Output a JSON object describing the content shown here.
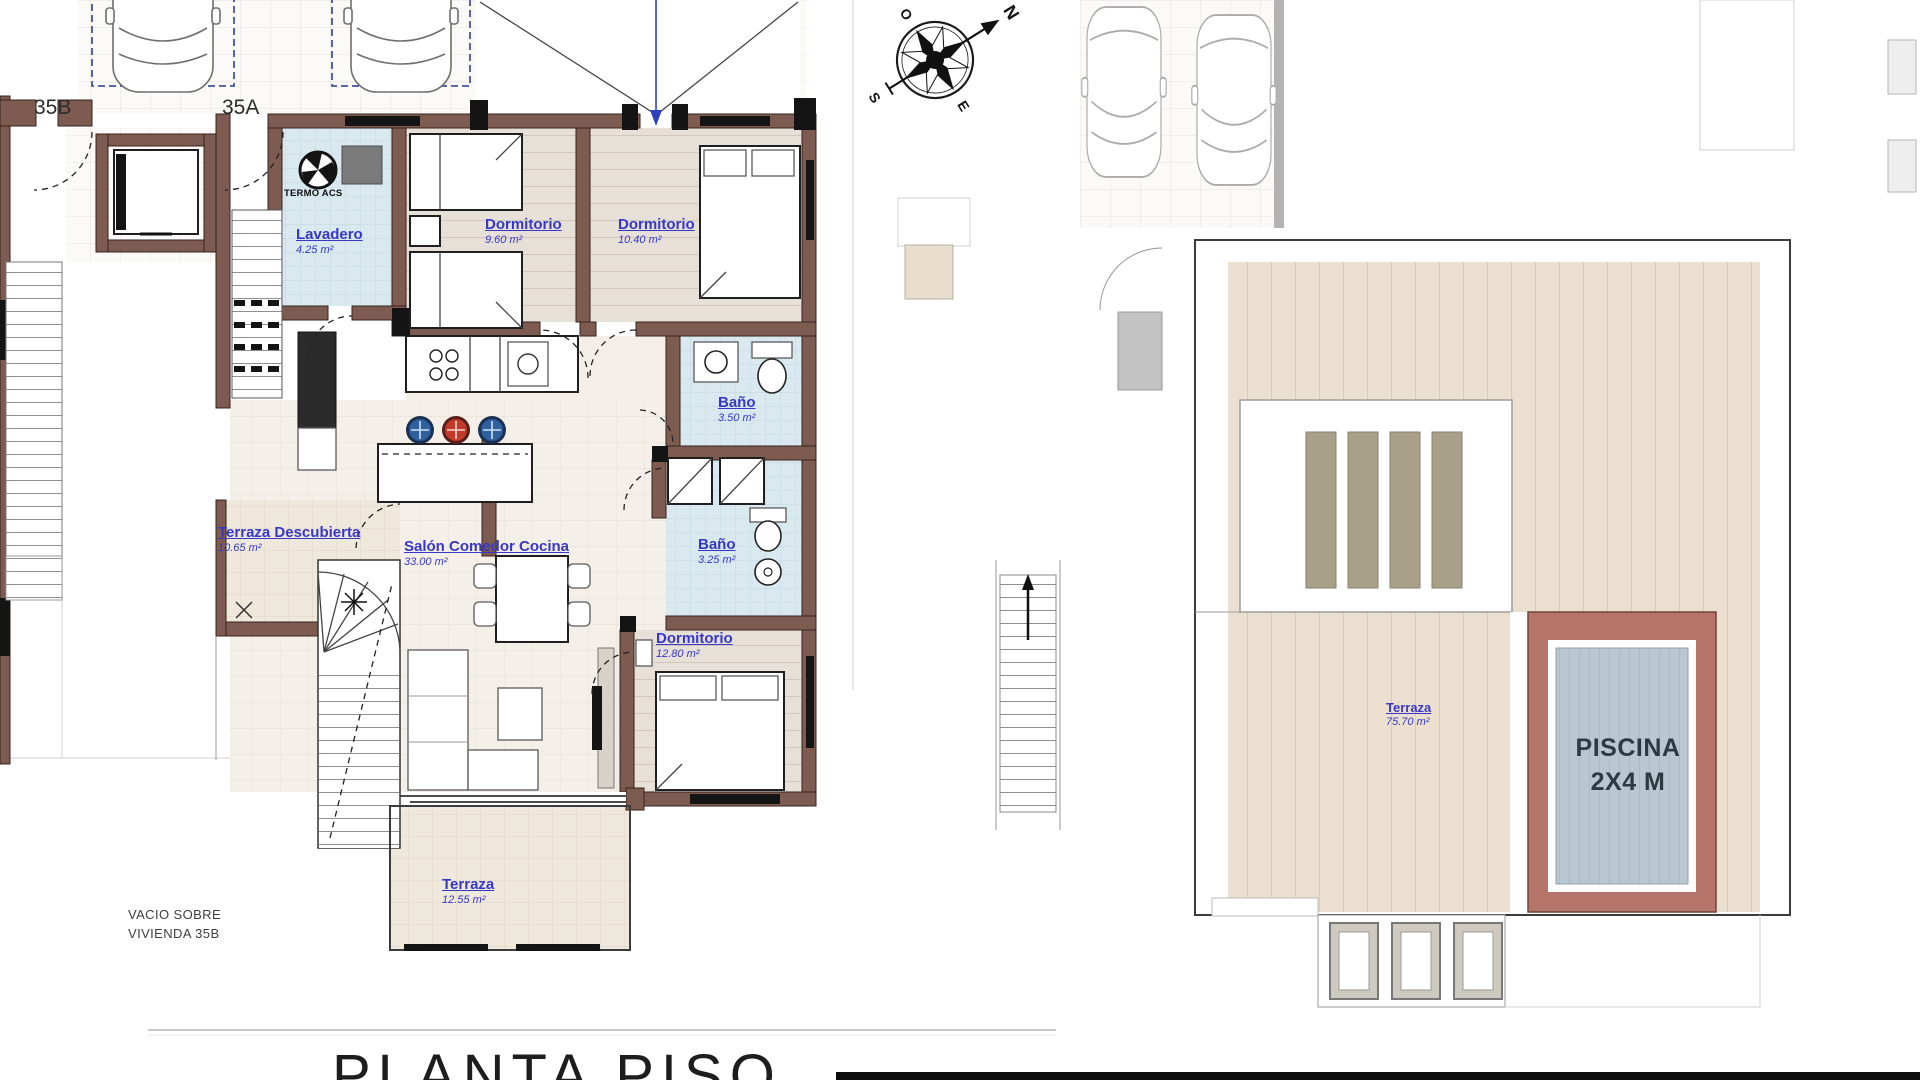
{
  "document": {
    "title_partial": "PLANTA PISO"
  },
  "compass": {
    "north": "N",
    "south": "S",
    "east": "E",
    "west": "O"
  },
  "plan_left": {
    "unit_labels": {
      "left": "35B",
      "right": "35A"
    },
    "equipment_label": "TERMO ACS",
    "rooms": [
      {
        "name": "Lavadero",
        "area": "4.25 m²"
      },
      {
        "name": "Dormitorio",
        "area": "9.60 m²"
      },
      {
        "name": "Dormitorio",
        "area": "10.40 m²"
      },
      {
        "name": "Baño",
        "area": "3.50 m²"
      },
      {
        "name": "Terraza Descubierta",
        "area": "10.65 m²"
      },
      {
        "name": "Salón Comedor Cocina",
        "area": "33.00 m²"
      },
      {
        "name": "Baño",
        "area": "3.25 m²"
      },
      {
        "name": "Dormitorio",
        "area": "12.80 m²"
      },
      {
        "name": "Terraza",
        "area": "12.55 m²"
      }
    ],
    "void_note": {
      "line1": "VACIO SOBRE",
      "line2": "VIVIENDA 35B"
    }
  },
  "plan_right": {
    "rooms": [
      {
        "name": "Terraza",
        "area": "75.70 m²"
      }
    ],
    "pool": {
      "line1": "PISCINA",
      "line2": "2X4 M"
    }
  },
  "colors": {
    "wall": "#7d5b50",
    "label_blue": "#3737c8",
    "entry_arrow": "#2d3fbe",
    "stool_blue": "#2e5f9e",
    "stool_red": "#c23b2a",
    "bath_floor": "#d9e9ef",
    "terrace_floor": "#efe9dd",
    "roof_deck": "#ebe0cf",
    "pool_deck": "#b5756a",
    "pool_water": "#b9c8d0",
    "title_text": "#1d1d1d"
  }
}
